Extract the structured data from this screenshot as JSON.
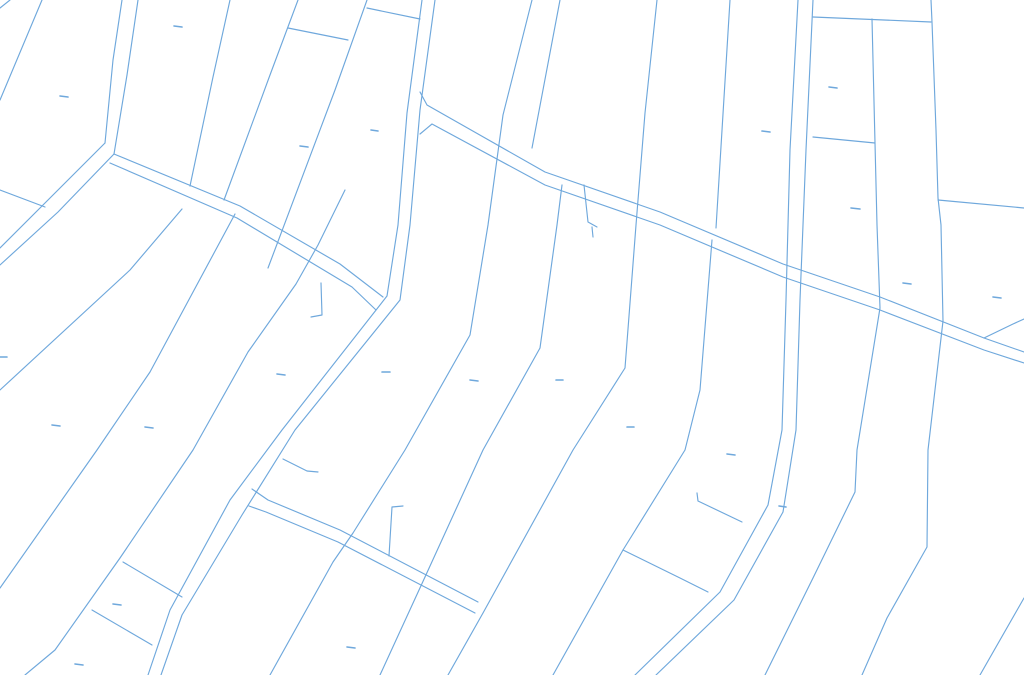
{
  "map": {
    "width": 1024,
    "height": 675,
    "background_color": "#ffffff",
    "line_color": "#6fa8dc",
    "line_width": 1.15,
    "dash_width": 1.6,
    "roads": [
      [
        [
          122,
          0
        ],
        [
          113,
          60
        ],
        [
          105,
          143
        ]
      ],
      [
        [
          138,
          0
        ],
        [
          127,
          75
        ],
        [
          114,
          154
        ]
      ],
      [
        [
          105,
          143
        ],
        [
          52,
          196
        ],
        [
          0,
          248
        ]
      ],
      [
        [
          114,
          154
        ],
        [
          58,
          212
        ],
        [
          0,
          265
        ]
      ],
      [
        [
          114,
          154
        ],
        [
          240,
          206
        ],
        [
          340,
          264
        ],
        [
          383,
          297
        ]
      ],
      [
        [
          110,
          163
        ],
        [
          237,
          218
        ],
        [
          352,
          287
        ],
        [
          376,
          310
        ]
      ],
      [
        [
          422,
          0
        ],
        [
          407,
          113
        ],
        [
          398,
          225
        ],
        [
          387,
          296
        ],
        [
          282,
          430
        ],
        [
          230,
          500
        ],
        [
          170,
          610
        ],
        [
          148,
          675
        ]
      ],
      [
        [
          435,
          0
        ],
        [
          420,
          110
        ],
        [
          410,
          225
        ],
        [
          400,
          300
        ],
        [
          295,
          430
        ],
        [
          242,
          515
        ],
        [
          182,
          615
        ],
        [
          161,
          675
        ]
      ],
      [
        [
          420,
          92
        ],
        [
          427,
          105
        ],
        [
          545,
          172
        ],
        [
          660,
          212
        ],
        [
          783,
          264
        ],
        [
          880,
          297
        ],
        [
          984,
          338
        ],
        [
          1024,
          352
        ]
      ],
      [
        [
          420,
          134
        ],
        [
          432,
          124
        ],
        [
          545,
          185
        ],
        [
          660,
          225
        ],
        [
          783,
          277
        ],
        [
          880,
          310
        ],
        [
          984,
          350
        ],
        [
          1024,
          363
        ]
      ],
      [
        [
          798,
          0
        ],
        [
          790,
          150
        ],
        [
          786,
          300
        ],
        [
          782,
          430
        ],
        [
          768,
          505
        ],
        [
          720,
          592
        ],
        [
          635,
          675
        ]
      ],
      [
        [
          813,
          0
        ],
        [
          806,
          150
        ],
        [
          800,
          300
        ],
        [
          796,
          430
        ],
        [
          783,
          512
        ],
        [
          734,
          600
        ],
        [
          656,
          675
        ]
      ],
      [
        [
          252,
          489
        ],
        [
          268,
          500
        ],
        [
          340,
          530
        ],
        [
          478,
          602
        ]
      ],
      [
        [
          249,
          506
        ],
        [
          266,
          512
        ],
        [
          338,
          542
        ],
        [
          475,
          613
        ]
      ]
    ],
    "parcel_lines": [
      [
        [
          0,
          8
        ],
        [
          10,
          0
        ]
      ],
      [
        [
          42,
          0
        ],
        [
          0,
          100
        ]
      ],
      [
        [
          0,
          190
        ],
        [
          45,
          207
        ]
      ],
      [
        [
          230,
          0
        ],
        [
          213,
          77
        ],
        [
          190,
          186
        ]
      ],
      [
        [
          182,
          209
        ],
        [
          130,
          270
        ],
        [
          0,
          390
        ]
      ],
      [
        [
          298,
          0
        ],
        [
          270,
          75
        ],
        [
          224,
          200
        ]
      ],
      [
        [
          235,
          214
        ],
        [
          150,
          372
        ],
        [
          97,
          450
        ],
        [
          0,
          588
        ]
      ],
      [
        [
          367,
          0
        ],
        [
          335,
          90
        ],
        [
          268,
          268
        ]
      ],
      [
        [
          345,
          190
        ],
        [
          318,
          245
        ],
        [
          296,
          284
        ],
        [
          248,
          352
        ],
        [
          193,
          450
        ],
        [
          120,
          558
        ],
        [
          55,
          650
        ],
        [
          25,
          675
        ]
      ],
      [
        [
          532,
          0
        ],
        [
          503,
          115
        ],
        [
          488,
          225
        ],
        [
          470,
          335
        ],
        [
          405,
          450
        ],
        [
          353,
          533
        ],
        [
          333,
          562
        ],
        [
          270,
          675
        ]
      ],
      [
        [
          560,
          0
        ],
        [
          532,
          148
        ]
      ],
      [
        [
          562,
          185
        ],
        [
          557,
          225
        ],
        [
          540,
          348
        ],
        [
          483,
          450
        ],
        [
          425,
          577
        ],
        [
          380,
          675
        ]
      ],
      [
        [
          657,
          0
        ],
        [
          645,
          113
        ],
        [
          636,
          225
        ],
        [
          625,
          368
        ],
        [
          573,
          450
        ],
        [
          483,
          613
        ],
        [
          448,
          675
        ]
      ],
      [
        [
          730,
          0
        ],
        [
          716,
          228
        ]
      ],
      [
        [
          712,
          240
        ],
        [
          700,
          390
        ],
        [
          685,
          450
        ],
        [
          623,
          550
        ],
        [
          553,
          675
        ]
      ],
      [
        [
          872,
          19
        ],
        [
          875,
          143
        ],
        [
          877,
          225
        ],
        [
          880,
          308
        ],
        [
          857,
          450
        ],
        [
          855,
          492
        ],
        [
          813,
          578
        ],
        [
          765,
          675
        ]
      ],
      [
        [
          931,
          0
        ],
        [
          932,
          22
        ],
        [
          936,
          130
        ],
        [
          938,
          198
        ],
        [
          941,
          225
        ],
        [
          943,
          321
        ],
        [
          928,
          450
        ],
        [
          927,
          547
        ],
        [
          887,
          618
        ],
        [
          862,
          675
        ]
      ],
      [
        [
          813,
          17
        ],
        [
          931,
          22
        ]
      ],
      [
        [
          813,
          137
        ],
        [
          875,
          143
        ]
      ],
      [
        [
          938,
          200
        ],
        [
          1024,
          208
        ]
      ],
      [
        [
          1024,
          598
        ],
        [
          980,
          675
        ]
      ],
      [
        [
          984,
          338
        ],
        [
          1013,
          324
        ],
        [
          1024,
          319
        ]
      ]
    ],
    "feature_lines": [
      [
        [
          288,
          28
        ],
        [
          348,
          40
        ]
      ],
      [
        [
          367,
          8
        ],
        [
          420,
          19
        ]
      ],
      [
        [
          321,
          283
        ],
        [
          322,
          315
        ],
        [
          311,
          317
        ]
      ],
      [
        [
          403,
          506
        ],
        [
          392,
          507
        ],
        [
          389,
          556
        ]
      ],
      [
        [
          584,
          185
        ],
        [
          588,
          222
        ],
        [
          597,
          227
        ]
      ],
      [
        [
          592,
          227
        ],
        [
          593,
          237
        ]
      ],
      [
        [
          623,
          550
        ],
        [
          680,
          578
        ],
        [
          708,
          592
        ]
      ],
      [
        [
          697,
          493
        ],
        [
          698,
          501
        ],
        [
          742,
          522
        ]
      ],
      [
        [
          123,
          562
        ],
        [
          182,
          597
        ]
      ],
      [
        [
          92,
          610
        ],
        [
          152,
          645
        ]
      ],
      [
        [
          283,
          459
        ],
        [
          307,
          471
        ],
        [
          318,
          472
        ]
      ]
    ],
    "dashes": [
      [
        60,
        96,
        68,
        97
      ],
      [
        174,
        26,
        182,
        27
      ],
      [
        300,
        146,
        308,
        147
      ],
      [
        371,
        130,
        378,
        131
      ],
      [
        762,
        131,
        770,
        132
      ],
      [
        829,
        87,
        837,
        88
      ],
      [
        851,
        208,
        860,
        209
      ],
      [
        0,
        357,
        7,
        357
      ],
      [
        52,
        425,
        60,
        426
      ],
      [
        145,
        427,
        153,
        428
      ],
      [
        277,
        374,
        285,
        375
      ],
      [
        382,
        372,
        390,
        372
      ],
      [
        470,
        380,
        478,
        381
      ],
      [
        556,
        380,
        563,
        380
      ],
      [
        627,
        427,
        634,
        427
      ],
      [
        903,
        283,
        911,
        284
      ],
      [
        993,
        297,
        1001,
        298
      ],
      [
        347,
        647,
        355,
        648
      ],
      [
        113,
        604,
        121,
        605
      ],
      [
        75,
        664,
        83,
        665
      ],
      [
        727,
        454,
        735,
        455
      ],
      [
        779,
        506,
        786,
        507
      ]
    ]
  }
}
